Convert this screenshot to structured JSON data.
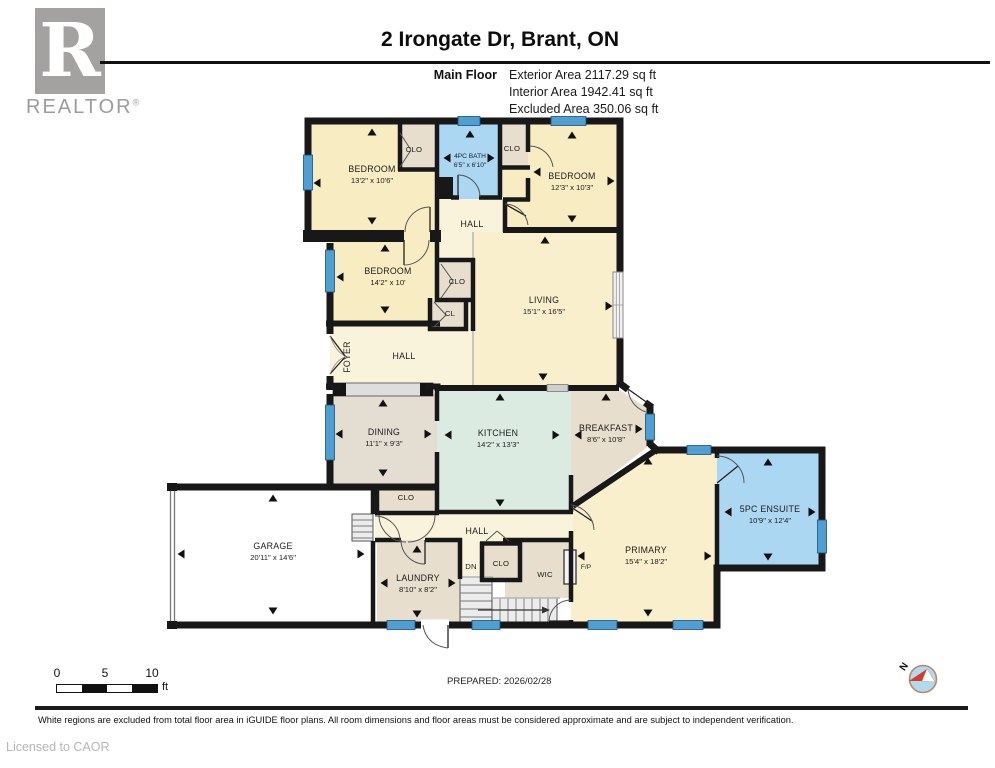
{
  "header": {
    "logo_letter": "R",
    "logo_word": "REALTOR",
    "logo_reg": "®",
    "title": "2 Irongate Dr, Brant, ON",
    "floor_label": "Main Floor",
    "area_exterior": "Exterior Area 2117.29 sq ft",
    "area_interior": "Interior Area 1942.41 sq ft",
    "area_excluded": "Excluded Area 350.06 sq ft"
  },
  "rooms": {
    "bedroom1": {
      "name": "BEDROOM",
      "dims": "13'2\" x 10'6\""
    },
    "bath": {
      "name": "4PC BATH",
      "dims": "6'5\" x 6'10\""
    },
    "bedroom2": {
      "name": "BEDROOM",
      "dims": "12'3\" x 10'3\""
    },
    "bedroom3": {
      "name": "BEDROOM",
      "dims": "14'2\" x 10'"
    },
    "living": {
      "name": "LIVING",
      "dims": "15'1\" x 16'5\""
    },
    "dining": {
      "name": "DINING",
      "dims": "11'1\" x 9'3\""
    },
    "kitchen": {
      "name": "KITCHEN",
      "dims": "14'2\" x 13'3\""
    },
    "breakfast": {
      "name": "BREAKFAST",
      "dims": "8'6\" x 10'8\""
    },
    "garage": {
      "name": "GARAGE",
      "dims": "20'11\" x 14'6\""
    },
    "laundry": {
      "name": "LAUNDRY",
      "dims": "8'10\" x 8'2\""
    },
    "primary": {
      "name": "PRIMARY",
      "dims": "15'4\" x 18'2\""
    },
    "ensuite": {
      "name": "5PC ENSUITE",
      "dims": "10'9\" x 12'4\""
    },
    "foyer": {
      "name": "FOYER"
    },
    "hall_upper": {
      "name": "HALL"
    },
    "hall_mid": {
      "name": "HALL"
    },
    "hall_lower": {
      "name": "HALL"
    },
    "wic": {
      "name": "WIC"
    },
    "clo1": {
      "name": "CLO"
    },
    "clo2": {
      "name": "CLO"
    },
    "clo3": {
      "name": "CLO"
    },
    "clo4": {
      "name": "CLO"
    },
    "clo5": {
      "name": "CLO"
    },
    "cl": {
      "name": "CL"
    },
    "dn": {
      "name": "DN"
    },
    "fp": {
      "name": "F/P"
    }
  },
  "scale": {
    "t0": "0",
    "t5": "5",
    "t10": "10",
    "unit": "ft"
  },
  "footer": {
    "prepared": "PREPARED: 2026/02/28",
    "north": "N",
    "disclaimer": "White regions are excluded from total floor area in iGUIDE floor plans. All room dimensions and floor areas must be considered approximate and are subject to independent verification.",
    "licensed": "Licensed to CAOR"
  },
  "colors": {
    "wall": "#181818",
    "room_cream": "#f8ecc2",
    "room_cream_light": "#faf3dc",
    "room_tan": "#e7decd",
    "room_dining": "#e3ddd2",
    "room_kitchen": "#dcebe2",
    "room_bath_blue": "#abd7f3",
    "window_blue": "#4f9fd2",
    "compass_red": "#d63c2a",
    "logo_gray": "#a3a2a1"
  }
}
